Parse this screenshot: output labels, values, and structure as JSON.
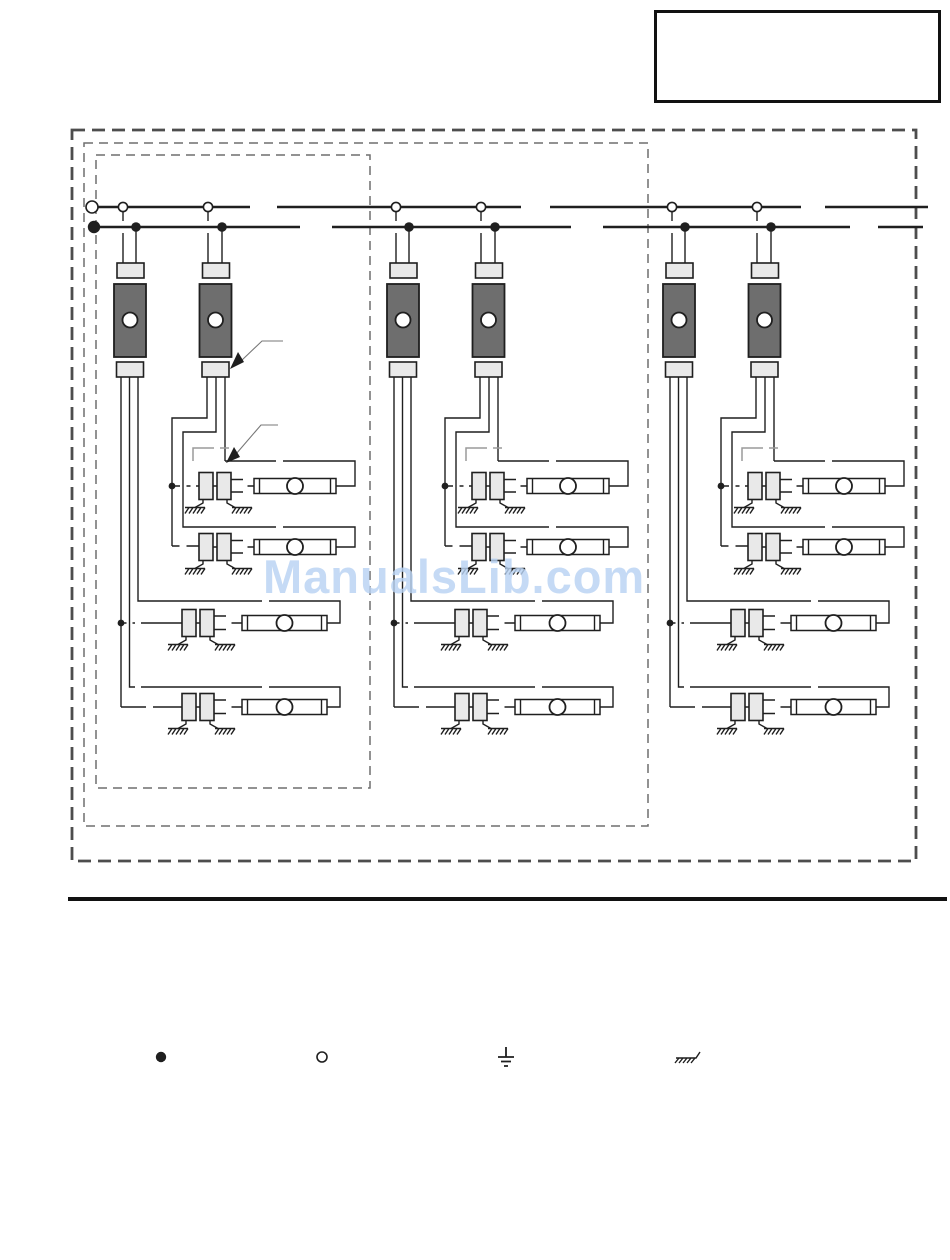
{
  "watermark": {
    "text": "ManualsLib.com",
    "color": "#b9d3f3"
  },
  "note_box": {
    "text": ""
  },
  "colors": {
    "line": "#1f1f1f",
    "ballast_fill": "#6e6e6e",
    "connector_fill": "#e9e9e9",
    "dashed_border": "#4d4d4d",
    "page_bg": "#ffffff"
  },
  "diagram": {
    "type": "wiring-schematic",
    "bus": {
      "upper_y": 207,
      "lower_y": 227,
      "upper_segments": [
        [
          98,
          250
        ],
        [
          277,
          521
        ],
        [
          550,
          801
        ],
        [
          825,
          928
        ]
      ],
      "lower_segments": [
        [
          100,
          300
        ],
        [
          332,
          571
        ],
        [
          603,
          850
        ],
        [
          878,
          923
        ]
      ]
    },
    "groups": [
      {
        "id": "circuit-group-1",
        "offset_x": 0
      },
      {
        "id": "circuit-group-2",
        "offset_x": 273
      },
      {
        "id": "circuit-group-3",
        "offset_x": 549
      }
    ]
  },
  "legend": {
    "items": [
      {
        "icon": "junction-dot-icon",
        "x": 161,
        "y": 1057
      },
      {
        "icon": "open-terminal-icon",
        "x": 322,
        "y": 1057
      },
      {
        "icon": "earth-ground-icon",
        "x": 506,
        "y": 1056
      },
      {
        "icon": "chassis-ground-icon",
        "x": 686,
        "y": 1056
      }
    ]
  }
}
